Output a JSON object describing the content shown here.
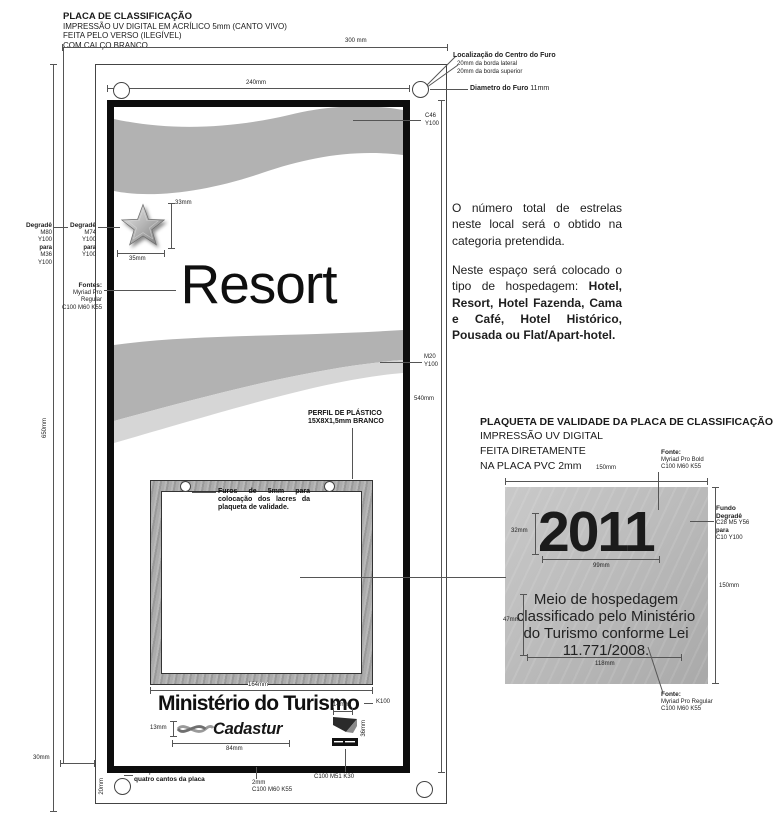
{
  "header": {
    "title": "PLACA DE CLASSIFICAÇÃO",
    "lines": [
      "IMPRESSÃO UV DIGITAL EM ACRÍLICO 5mm (CANTO VIVO)",
      "FEITA PELO VERSO (ILEGÍVEL)",
      "COM CALÇO BRANCO"
    ]
  },
  "dims": {
    "sheet_width": "300 mm",
    "art_width": "240mm",
    "sheet_height": "650mm",
    "art_height": "540mm",
    "star_h": "33mm",
    "star_w": "35mm",
    "frame_w": "164mm",
    "cadastur_h": "13mm",
    "cadastur_w": "84mm",
    "mark_w": "14mm",
    "mark_h": "36mm",
    "hole_x": "30mm",
    "hole_y": "20mm"
  },
  "hole_note": {
    "title": "Localização do Centro do Furo",
    "line1": "20mm da borda lateral",
    "line2": "20mm da borda superior",
    "diameter_label": "Diametro do Furo",
    "diameter_value": "11mm"
  },
  "degrade_outer": {
    "title": "Degradê",
    "l1": "M80",
    "l2": "Y100",
    "l3": "para",
    "l4": "M36",
    "l5": "Y100"
  },
  "degrade_star": {
    "title": "Degradê",
    "l1": "M74",
    "l2": "Y100",
    "l3": "para",
    "l4": "Y100"
  },
  "fontes": {
    "title": "Fontes:",
    "l1": "Myriad Pro",
    "l2": "Regular",
    "l3": "C100 M60 K55"
  },
  "swatch_top": {
    "l1": "C46",
    "l2": "Y100"
  },
  "swatch_mid": {
    "l1": "M20",
    "l2": "Y100"
  },
  "plate": {
    "category": "Resort",
    "ministry": "Ministério do Turismo",
    "ministry_color": "K100",
    "cadastur": "Cadastur",
    "profile_l1": "PERFIL DE PLÁSTICO",
    "profile_l2": "15X8X1,5mm BRANCO",
    "holes_note": "Furos de 5mm para colocação dos lacres da plaqueta de validade.",
    "corner_note": "Posição dos furos nos quatro cantos da placa",
    "border_l1": "2mm",
    "border_l2": "C100 M60 K55",
    "mark_color": "C100 M51 K30"
  },
  "notes": {
    "p1": "O número total de estrelas neste local será o obtido na categoria pretendida.",
    "p2_normal": "Neste espaço será colocado o tipo de hospedagem: ",
    "p2_bold": "Hotel, Resort, Hotel Fazenda, Cama e Café, Hotel Histórico, Pousada ou Flat/Apart-hotel."
  },
  "plaqueta": {
    "title": "PLAQUETA DE VALIDADE DA PLACA DE CLASSIFICAÇÃO",
    "lines": [
      "IMPRESSÃO UV DIGITAL",
      "FEITA DIRETAMENTE",
      "NA PLACA PVC 2mm"
    ],
    "year": "2011",
    "body": "Meio de hospedagem classificado pelo Ministério do Turismo conforme Lei 11.771/2008.",
    "w_top": "150mm",
    "year_h": "32mm",
    "year_w": "99mm",
    "body_h": "47mm",
    "body_w": "118mm",
    "h_right": "150mm",
    "font_bold": {
      "title": "Fonte:",
      "l1": "Myriad Pro Bold",
      "l2": "C100 M60 K55"
    },
    "fundo": {
      "t1": "Fundo",
      "t2": "Degradê",
      "l1": "C28 M5 Y56",
      "l2": "para",
      "l3": "C10 Y100"
    },
    "font_reg": {
      "title": "Fonte:",
      "l1": "Myriad Pro Regular",
      "l2": "C100 M60 K55"
    }
  }
}
